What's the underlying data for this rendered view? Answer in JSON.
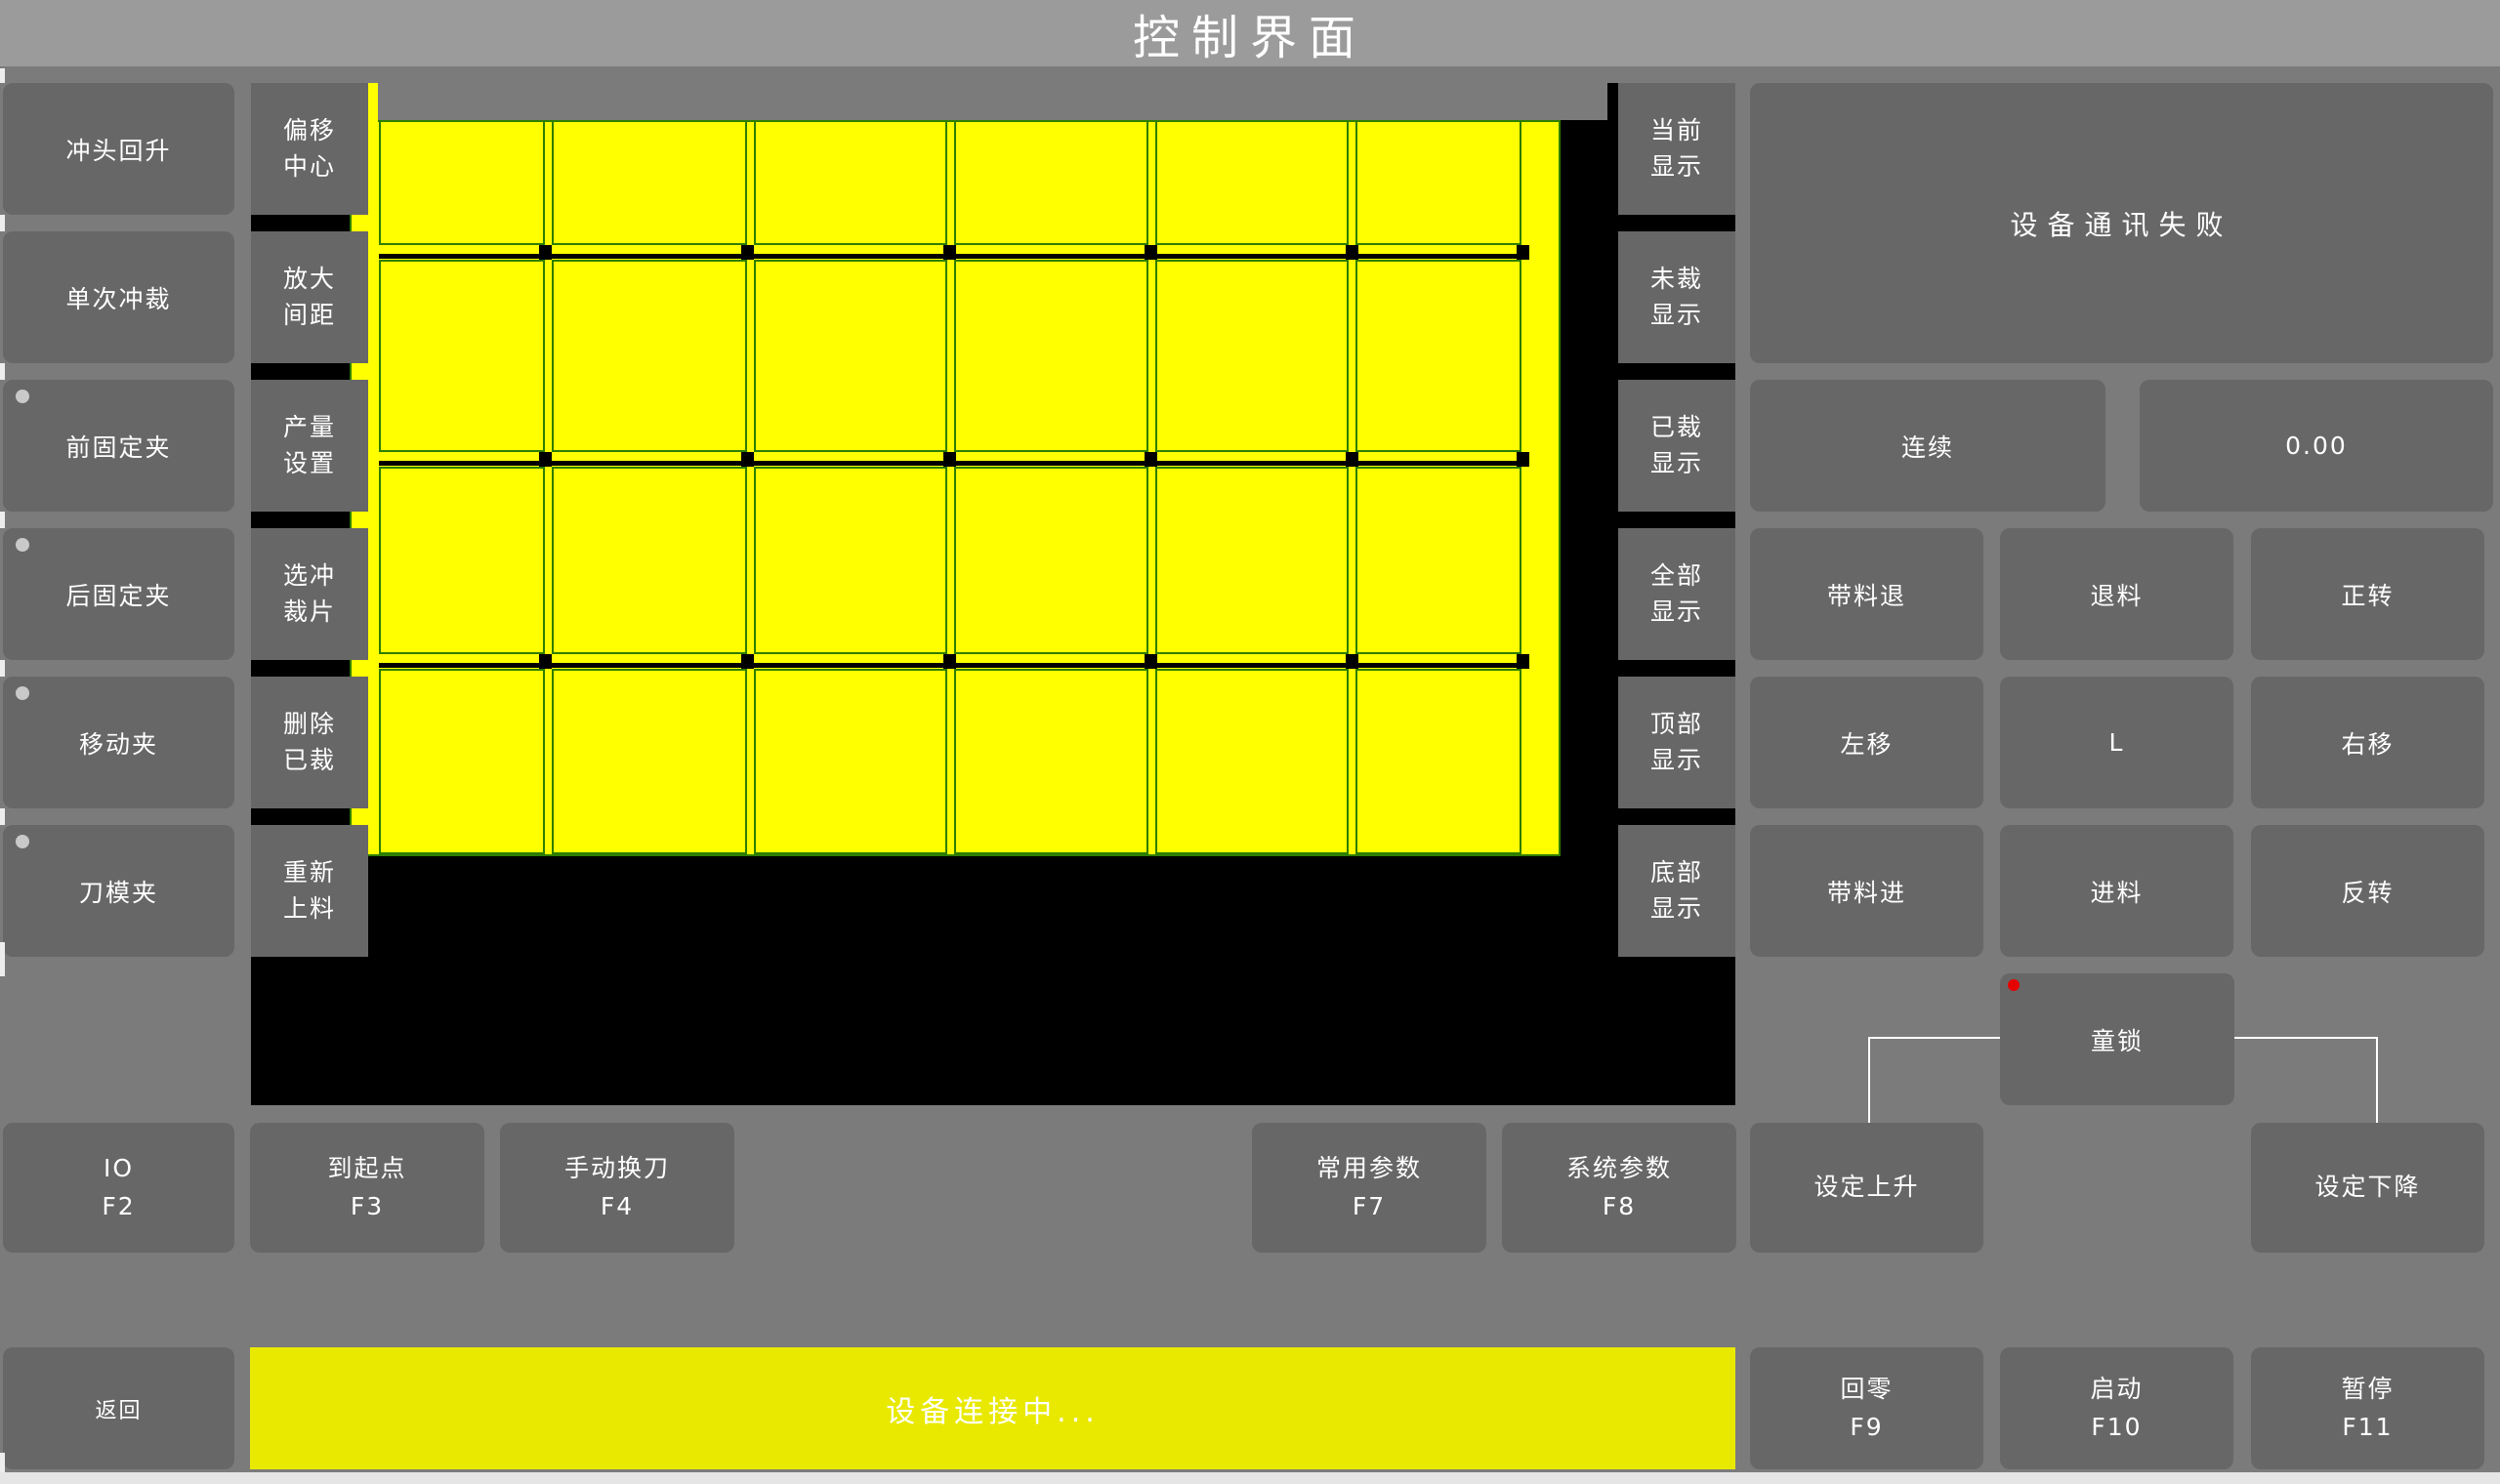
{
  "title": "控制界面",
  "colors": {
    "background": "#7b7b7b",
    "titlebar": "#9b9b9b",
    "button_gray": "#676767",
    "canvas_black": "#000000",
    "sheet_yellow": "#ffff00",
    "cut_line_green": "#2e7e00",
    "status_bar_yellow": "#e9e900",
    "alert_red": "#e60000",
    "indicator_gray": "#c9c9c9"
  },
  "left_buttons": [
    {
      "label": "冲头回升",
      "indicator": false
    },
    {
      "label": "单次冲裁",
      "indicator": false
    },
    {
      "label": "前固定夹",
      "indicator": true
    },
    {
      "label": "后固定夹",
      "indicator": true
    },
    {
      "label": "移动夹",
      "indicator": true
    },
    {
      "label": "刀模夹",
      "indicator": true
    }
  ],
  "tool_buttons": [
    {
      "label": "偏移中心"
    },
    {
      "label": "放大间距"
    },
    {
      "label": "产量设置"
    },
    {
      "label": "选冲裁片"
    },
    {
      "label": "删除已裁"
    },
    {
      "label": "重新上料"
    }
  ],
  "display_buttons": [
    {
      "label": "当前显示"
    },
    {
      "label": "未裁显示"
    },
    {
      "label": "已裁显示"
    },
    {
      "label": "全部显示"
    },
    {
      "label": "顶部显示"
    },
    {
      "label": "底部显示"
    }
  ],
  "sheet_preview": {
    "rows": 4,
    "cols": 6
  },
  "right_panel": {
    "message": "设备通讯失败",
    "mode_button": "连续",
    "value_display": "0.00",
    "jog_buttons": [
      [
        "带料退",
        "退料",
        "正转"
      ],
      [
        "左移",
        "L",
        "右移"
      ],
      [
        "带料进",
        "进料",
        "反转"
      ]
    ],
    "lock_button": "童锁"
  },
  "function_keys": [
    {
      "label": "IO",
      "key": "F2"
    },
    {
      "label": "到起点",
      "key": "F3"
    },
    {
      "label": "手动换刀",
      "key": "F4"
    },
    {
      "label": "常用参数",
      "key": "F7"
    },
    {
      "label": "系统参数",
      "key": "F8"
    },
    {
      "label": "设定上升",
      "key": ""
    },
    {
      "label": "设定下降",
      "key": ""
    }
  ],
  "bottom_bar": {
    "back": "返回",
    "status": "设备连接中...",
    "keys": [
      {
        "label": "回零",
        "key": "F9"
      },
      {
        "label": "启动",
        "key": "F10"
      },
      {
        "label": "暂停",
        "key": "F11"
      }
    ]
  }
}
